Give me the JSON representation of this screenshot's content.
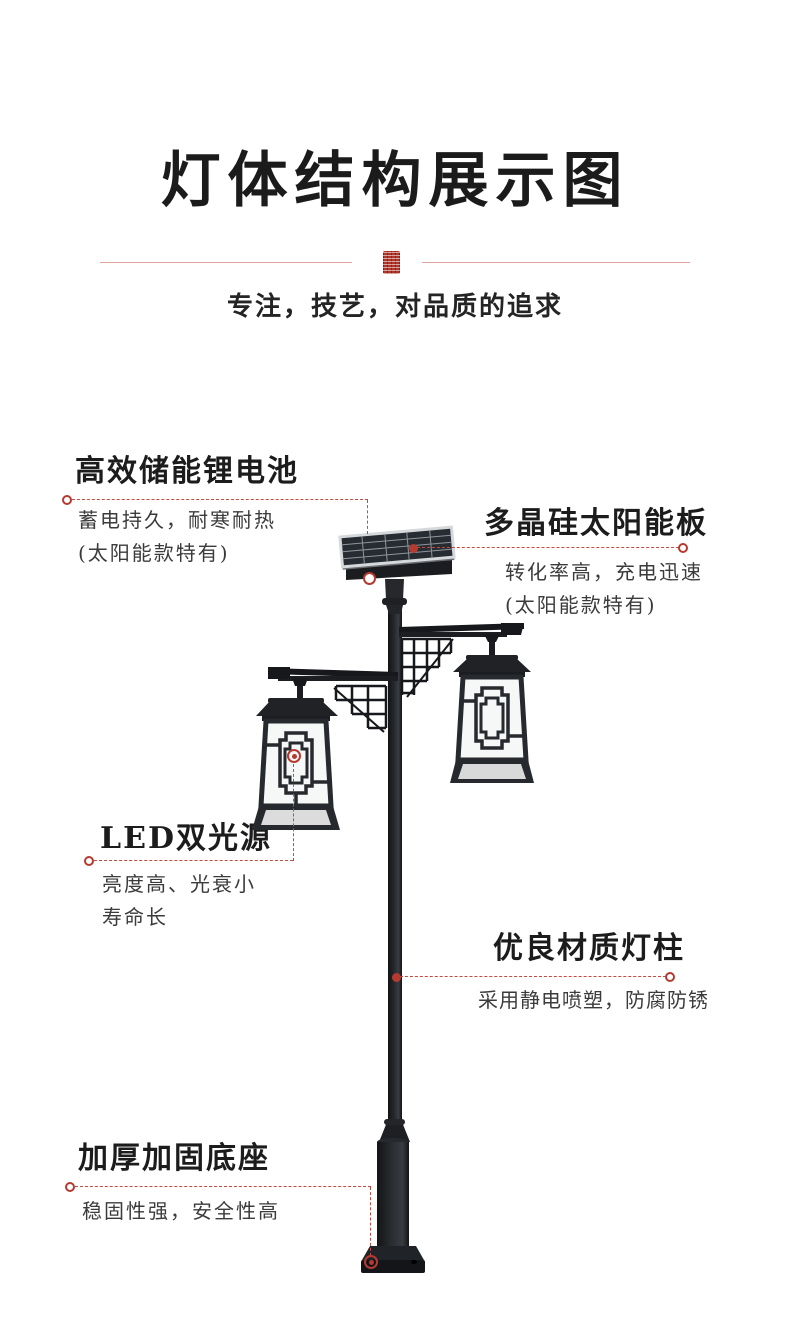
{
  "header": {
    "title": "灯体结构展示图",
    "subtitle": "专注，技艺，对品质的追求"
  },
  "colors": {
    "accent_red": "#b53a30",
    "divider_pink": "#dfa49e",
    "lamp_black": "#1d2024",
    "lantern_panel_white": "#f6f7f7",
    "solar_cell_dark": "#272c33",
    "solar_frame_silver": "#d6d9dc"
  },
  "callouts": [
    {
      "id": "battery",
      "title": "高效储能锂电池",
      "desc_lines": [
        "蓄电持久，耐寒耐热",
        "(太阳能款特有)"
      ]
    },
    {
      "id": "solar-panel",
      "title": "多晶硅太阳能板",
      "desc_lines": [
        "转化率高，充电迅速",
        "(太阳能款特有)"
      ]
    },
    {
      "id": "led",
      "title": "LED双光源",
      "desc_lines": [
        "亮度高、光衰小",
        "寿命长"
      ]
    },
    {
      "id": "pole",
      "title": "优良材质灯柱",
      "desc_lines": [
        "采用静电喷塑，防腐防锈"
      ]
    },
    {
      "id": "base",
      "title": "加厚加固底座",
      "desc_lines": [
        "稳固性强，安全性高"
      ]
    }
  ]
}
